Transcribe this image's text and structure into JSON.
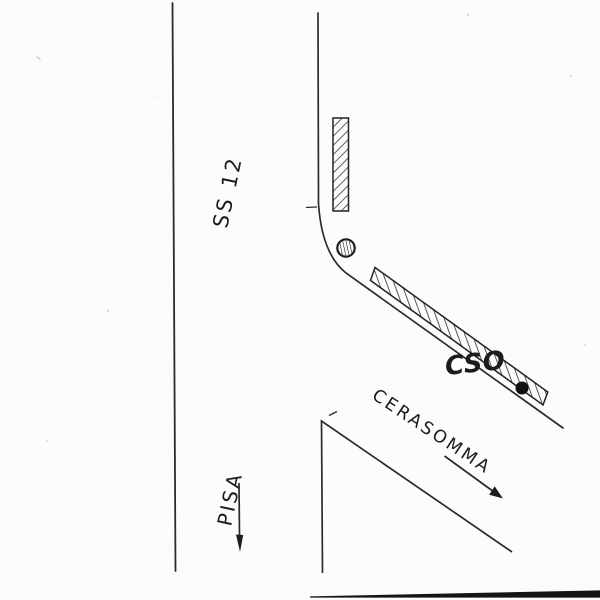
{
  "canvas": {
    "paper_color": "#fcfcfb",
    "ink_color": "#272727"
  },
  "labels": {
    "route_number": "SS 12",
    "direction_south": "PISA",
    "road_name": "CERASOMMA",
    "site_code": "CSO"
  }
}
